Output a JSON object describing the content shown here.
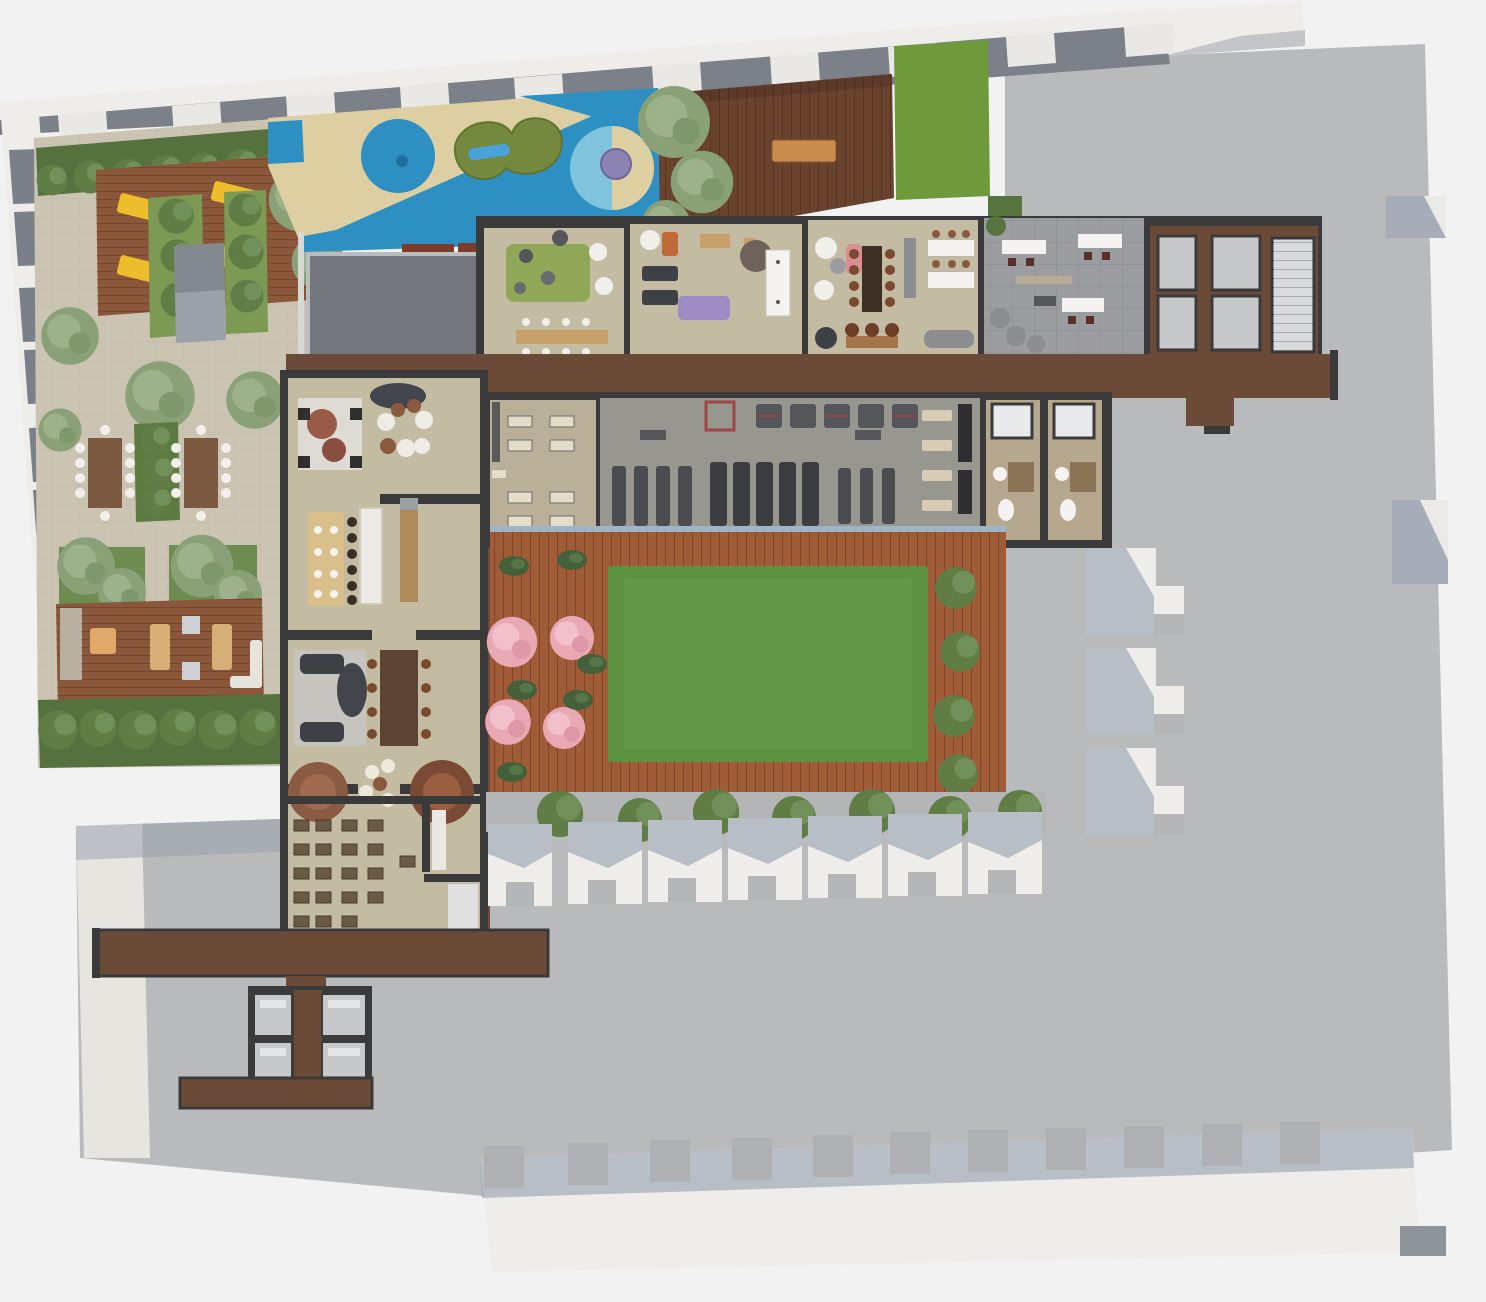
{
  "scene": {
    "kind": "architectural-floorplan-rendering",
    "view": "top-down amenity level with courtyard"
  },
  "colors": {
    "bg": "#f2f2f3",
    "facade": "#eeede9",
    "roof_dark": "#7b8089",
    "slab": "#b9babc",
    "slab_shadow": "#a6adb9",
    "canopy": "#73767c",
    "paving": "#cbc4b3",
    "hedge": "#55713e",
    "bush": "#5f7d45",
    "tree": "#8aa178",
    "grass_strip": "#6e9a3b",
    "lawn": "#5c9140",
    "blossom": "#e8a9b5",
    "deck_sun": "#8a573a",
    "deck_walnut": "#6a432f",
    "deck_courtyard": "#a05c36",
    "wood_corridor": "#6b4a38",
    "wall": "#3a3a3b",
    "floor": "#c4bba3",
    "floor_studio": "#bab09a",
    "gym_floor": "#97978f",
    "tile_gray": "#9b9da0",
    "shaft": "#c6c8ca",
    "sand": "#decfa3",
    "pool_blue": "#2e8fc3",
    "pool_light": "#80c3dc",
    "play_mound": "#74883e",
    "lounger_yellow": "#eebd2b",
    "mat_purple": "#9f8cc4",
    "white_furniture": "#f4f3f1",
    "parapet_line": "#9fb4c4"
  },
  "areas": [
    {
      "id": "garden-terrace",
      "label": "landscaped garden terrace"
    },
    {
      "id": "sun-deck",
      "label": "sun deck with loungers"
    },
    {
      "id": "play-area",
      "label": "children's play surface"
    },
    {
      "id": "walnut-deck",
      "label": "timber roof deck"
    },
    {
      "id": "kids-room",
      "label": "playroom"
    },
    {
      "id": "treatment-room",
      "label": "treatment / games room"
    },
    {
      "id": "lounge-bar",
      "label": "lounge with bar"
    },
    {
      "id": "coworking-room",
      "label": "co-working lounge"
    },
    {
      "id": "elevator-core",
      "label": "elevator core and stair"
    },
    {
      "id": "fitness-studio",
      "label": "fitness studio"
    },
    {
      "id": "gym",
      "label": "gym"
    },
    {
      "id": "changing-rooms",
      "label": "changing rooms"
    },
    {
      "id": "residents-lounge",
      "label": "residents' lounge suites"
    },
    {
      "id": "screening-room",
      "label": "screening room"
    },
    {
      "id": "courtyard-lawn",
      "label": "courtyard lawn"
    },
    {
      "id": "courtyard-deck",
      "label": "courtyard deck with cherry trees"
    },
    {
      "id": "private-terraces",
      "label": "private terraces"
    },
    {
      "id": "elevator-lobby",
      "label": "lower elevator lobby"
    }
  ]
}
